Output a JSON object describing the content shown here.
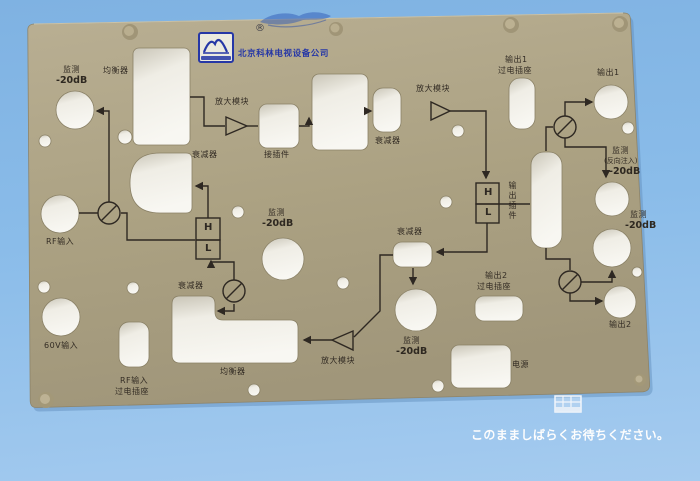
{
  "overlay": {
    "message": "このまましばらくお待ちください。",
    "status_icon": "table-grid-icon"
  },
  "colors": {
    "background": "#8abce9",
    "panel": "#aea387",
    "logo_blue": "#2637a6",
    "line": "#2e2822",
    "overlay_text": "#ffffff"
  },
  "panel": {
    "logo": {
      "company": "北京科林电视设备公司",
      "mark": "®",
      "logo_icon": "arch-logo"
    },
    "diplexer": {
      "high": "H",
      "low": "L"
    },
    "labels": {
      "monitor_tl_1": "监测",
      "monitor_tl_2": "-20dB",
      "equalizer_top": "均衡器",
      "amp_top": "放大模块",
      "connector": "接插件",
      "attn_c": "衰减器",
      "amp_right": "放大模块",
      "out1_socket_1": "输出1",
      "out1_socket_2": "过电插座",
      "out1": "输出1",
      "monitor_rev_1": "监测",
      "monitor_rev_2": "(反向注入)",
      "monitor_rev_3": "-20dB",
      "monitor_r_1": "监测",
      "monitor_r_2": "-20dB",
      "output_module": "输出插件",
      "attn_mid": "衰减器",
      "monitor_c_1": "监测",
      "monitor_c_2": "-20dB",
      "attn_d": "衰减器",
      "attn_l": "衰减器",
      "rf_in": "RF输入",
      "out2_socket_1": "输出2",
      "out2_socket_2": "过电插座",
      "out2": "输出2",
      "power": "电源",
      "monitor_b_1": "监测",
      "monitor_b_2": "-20dB",
      "equalizer_bottom": "均衡器",
      "amp_bottom": "放大模块",
      "v60_in": "60V输入",
      "rf_socket_1": "RF输入",
      "rf_socket_2": "过电插座"
    }
  }
}
